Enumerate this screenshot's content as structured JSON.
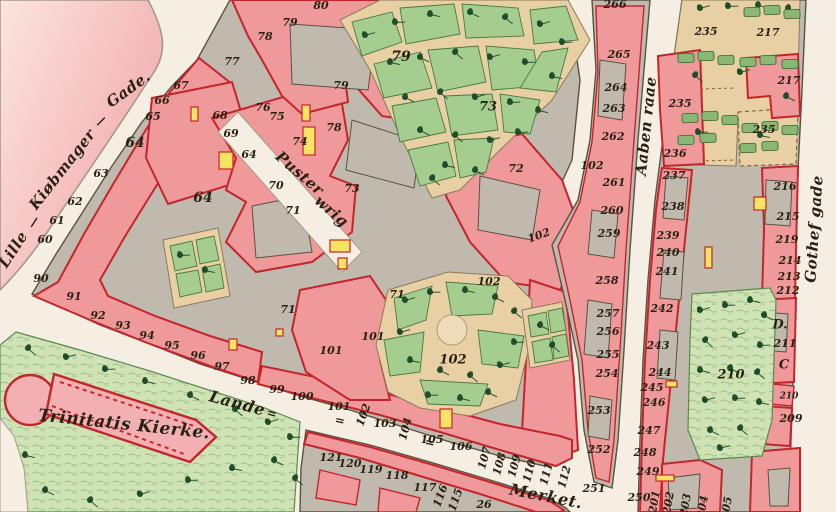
{
  "map": {
    "title": "Historical quarter map — Trinitatis Kierke",
    "region_labels": {
      "church": {
        "text": "Trinitatis Kierke.",
        "x": 124,
        "y": 425,
        "rotate": 6,
        "size": 17
      }
    },
    "streets": [
      {
        "text": "Lille",
        "x": 14,
        "y": 250,
        "rotate": -57,
        "size": 15
      },
      {
        "text": "—",
        "x": 34,
        "y": 222,
        "rotate": -57,
        "size": 12
      },
      {
        "text": "Kiøbmager",
        "x": 63,
        "y": 170,
        "rotate": -52,
        "size": 15
      },
      {
        "text": "—",
        "x": 101,
        "y": 121,
        "rotate": -45,
        "size": 12
      },
      {
        "text": "Gade.",
        "x": 129,
        "y": 90,
        "rotate": -36,
        "size": 15
      },
      {
        "text": "Puster",
        "x": 299,
        "y": 174,
        "rotate": 41,
        "size": 15
      },
      {
        "text": "wrig",
        "x": 331,
        "y": 212,
        "rotate": 41,
        "size": 15
      },
      {
        "text": "Aaben raae",
        "x": 647,
        "y": 126,
        "rotate": -84,
        "size": 15
      },
      {
        "text": "Gothef gade",
        "x": 815,
        "y": 229,
        "rotate": -86,
        "size": 15
      },
      {
        "text": "Lande",
        "x": 237,
        "y": 404,
        "rotate": 15,
        "size": 16
      },
      {
        "text": "Merket.",
        "x": 546,
        "y": 497,
        "rotate": 11,
        "size": 16
      }
    ],
    "street_dashes": [
      {
        "text": "=",
        "x": 272,
        "y": 414,
        "rotate": 15
      },
      {
        "text": "=",
        "x": 340,
        "y": 421,
        "rotate": 12
      },
      {
        "text": "=",
        "x": 430,
        "y": 443,
        "rotate": 12
      }
    ],
    "district_letters": [
      {
        "text": "D.",
        "x": 780,
        "y": 325,
        "size": 13
      },
      {
        "text": "C",
        "x": 784,
        "y": 365,
        "size": 13
      }
    ],
    "plots": [
      [
        60,
        45,
        240
      ],
      [
        61,
        57,
        221
      ],
      [
        62,
        75,
        202
      ],
      [
        63,
        101,
        174
      ],
      [
        64,
        135,
        143,
        0,
        14
      ],
      [
        65,
        153,
        117
      ],
      [
        66,
        162,
        101
      ],
      [
        67,
        181,
        86
      ],
      [
        68,
        220,
        116
      ],
      [
        69,
        231,
        134
      ],
      [
        64,
        249,
        155
      ],
      [
        64,
        203,
        198,
        0,
        14
      ],
      [
        70,
        276,
        186
      ],
      [
        71,
        293,
        211
      ],
      [
        75,
        277,
        117
      ],
      [
        76,
        263,
        108
      ],
      [
        77,
        232,
        62
      ],
      [
        78,
        265,
        37
      ],
      [
        79,
        290,
        23
      ],
      [
        80,
        321,
        6
      ],
      [
        79,
        341,
        86
      ],
      [
        79,
        401,
        57,
        0,
        14
      ],
      [
        78,
        334,
        128
      ],
      [
        74,
        300,
        142
      ],
      [
        73,
        352,
        189
      ],
      [
        73,
        488,
        107,
        0,
        13
      ],
      [
        72,
        516,
        169
      ],
      [
        71,
        288,
        310
      ],
      [
        71,
        397,
        295
      ],
      [
        90,
        41,
        279
      ],
      [
        91,
        74,
        297
      ],
      [
        92,
        98,
        316
      ],
      [
        93,
        123,
        326
      ],
      [
        94,
        147,
        336
      ],
      [
        95,
        172,
        346
      ],
      [
        96,
        198,
        356
      ],
      [
        97,
        222,
        367
      ],
      [
        98,
        248,
        381
      ],
      [
        99,
        277,
        390
      ],
      [
        100,
        302,
        397
      ],
      [
        101,
        339,
        407
      ],
      [
        101,
        331,
        351
      ],
      [
        101,
        373,
        337
      ],
      [
        102,
        364,
        415,
        -70
      ],
      [
        103,
        385,
        424
      ],
      [
        104,
        406,
        429,
        -75
      ],
      [
        105,
        432,
        440
      ],
      [
        106,
        461,
        447
      ],
      [
        107,
        485,
        458,
        -75
      ],
      [
        108,
        500,
        464,
        -75
      ],
      [
        109,
        515,
        466,
        -75
      ],
      [
        110,
        530,
        471,
        -75
      ],
      [
        111,
        547,
        474,
        -75
      ],
      [
        112,
        565,
        477,
        -75
      ],
      [
        115,
        456,
        500,
        -70
      ],
      [
        116,
        441,
        496,
        -70
      ],
      [
        117,
        425,
        488
      ],
      [
        118,
        397,
        476
      ],
      [
        119,
        371,
        470
      ],
      [
        120,
        350,
        464
      ],
      [
        121,
        331,
        458
      ],
      [
        26,
        484,
        505
      ],
      [
        102,
        489,
        282
      ],
      [
        102,
        539,
        236,
        -20
      ],
      [
        102,
        453,
        360,
        0,
        13
      ],
      [
        102,
        592,
        166
      ],
      [
        201,
        655,
        502,
        -80
      ],
      [
        202,
        669,
        503,
        -80
      ],
      [
        203,
        686,
        505,
        -80
      ],
      [
        204,
        703,
        507,
        -80
      ],
      [
        205,
        727,
        508,
        -80
      ],
      [
        209,
        791,
        419
      ],
      [
        210,
        731,
        375,
        0,
        13
      ],
      [
        210,
        789,
        396,
        0,
        9
      ],
      [
        211,
        785,
        344
      ],
      [
        212,
        788,
        291
      ],
      [
        213,
        789,
        277
      ],
      [
        214,
        790,
        261
      ],
      [
        215,
        788,
        217
      ],
      [
        216,
        785,
        187
      ],
      [
        217,
        768,
        33
      ],
      [
        217,
        789,
        81
      ],
      [
        219,
        787,
        240
      ],
      [
        235,
        706,
        32
      ],
      [
        235,
        680,
        104
      ],
      [
        235,
        764,
        130
      ],
      [
        236,
        675,
        154
      ],
      [
        237,
        674,
        176
      ],
      [
        238,
        673,
        207
      ],
      [
        239,
        668,
        236
      ],
      [
        240,
        668,
        253
      ],
      [
        241,
        667,
        272
      ],
      [
        242,
        662,
        309
      ],
      [
        243,
        658,
        346
      ],
      [
        244,
        660,
        373
      ],
      [
        245,
        652,
        388
      ],
      [
        246,
        654,
        403
      ],
      [
        247,
        649,
        431
      ],
      [
        248,
        645,
        453
      ],
      [
        249,
        648,
        472
      ],
      [
        250,
        639,
        498
      ],
      [
        251,
        594,
        489
      ],
      [
        252,
        599,
        450
      ],
      [
        253,
        599,
        411
      ],
      [
        254,
        607,
        374
      ],
      [
        255,
        608,
        355
      ],
      [
        256,
        608,
        332
      ],
      [
        257,
        608,
        314
      ],
      [
        258,
        607,
        281
      ],
      [
        259,
        609,
        234
      ],
      [
        260,
        612,
        211
      ],
      [
        261,
        614,
        183
      ],
      [
        262,
        613,
        137
      ],
      [
        263,
        614,
        109
      ],
      [
        264,
        616,
        88
      ],
      [
        265,
        619,
        55
      ],
      [
        266,
        615,
        5
      ]
    ],
    "colors": {
      "paper": "#f4efe2",
      "building_pink": "#f0999b",
      "outline_red": "#c4252a",
      "courtyard_gray": "#bfbaad",
      "garden_green": "#cfe3b5",
      "tree_green": "#1f4c29",
      "path_tan": "#e9cfa4",
      "accent_yellow": "#f5e361",
      "ink": "#2a2115",
      "wash_pink": "#f3b0b2"
    }
  }
}
